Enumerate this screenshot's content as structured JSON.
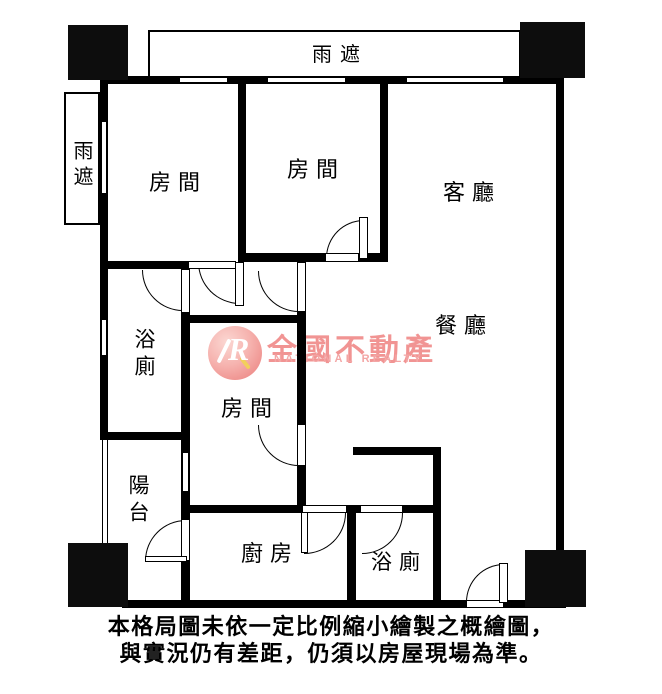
{
  "page": {
    "width": 662,
    "height": 694,
    "background": "#ffffff",
    "wall_color": "#000000"
  },
  "floorplan": {
    "labels": {
      "canopy_top": "雨遮",
      "canopy_left": "雨遮",
      "bedroom_top_left": "房間",
      "bedroom_top_center": "房間",
      "bedroom_center": "房間",
      "living_room": "客廳",
      "dining_room": "餐廳",
      "bathroom_main": "浴廁",
      "bathroom_rear": "浴廁",
      "balcony": "陽台",
      "kitchen": "廚房"
    }
  },
  "watermark": {
    "logo_letter": "R",
    "brand": "全國不動產",
    "subtitle": "NATIONAL REALTY",
    "color": "#f19493"
  },
  "disclaimer": {
    "line1": "本格局圖未依一定比例縮小繪製之概繪圖，",
    "line2": "與實況仍有差距，仍須以房屋現場為準。"
  }
}
